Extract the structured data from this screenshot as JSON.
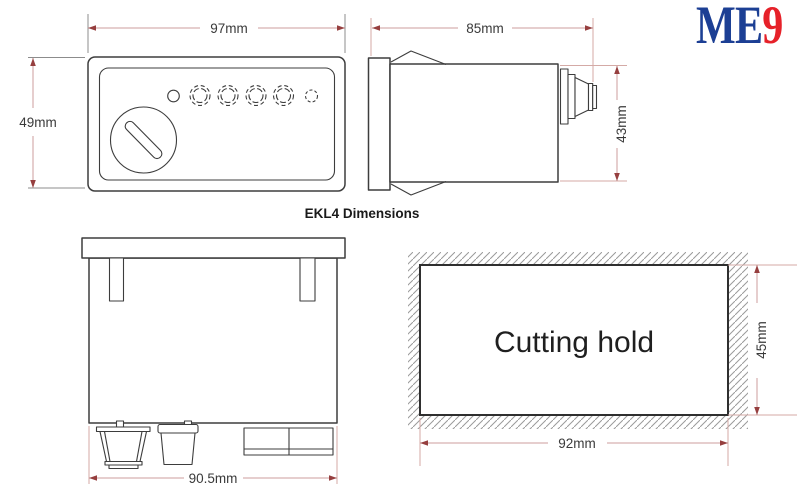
{
  "title": "EKL4 Dimensions",
  "logo": {
    "text_blue": "ME",
    "text_red": "9"
  },
  "views": {
    "front": {
      "width_label": "97mm",
      "height_label": "49mm"
    },
    "side": {
      "width_label": "85mm",
      "height_label": "43mm"
    },
    "rear": {
      "width_label": "90.5mm"
    },
    "cutout": {
      "label": "Cutting hold",
      "width_label": "92mm",
      "height_label": "45mm"
    }
  },
  "colors": {
    "outline": "#3d3d3d",
    "dim_line": "#cc9e9e",
    "dim_arrow": "#963f3f",
    "ext_gray": "#8c8c8c",
    "ext_pink": "#d4aaa6",
    "hatch": "#9a9a9a",
    "text": "#3a3a3a",
    "cutout_text": "#1f1f1f",
    "cutout_border": "#2f2f2f",
    "logo_blue": "#1c3f94",
    "logo_red": "#e62129"
  }
}
